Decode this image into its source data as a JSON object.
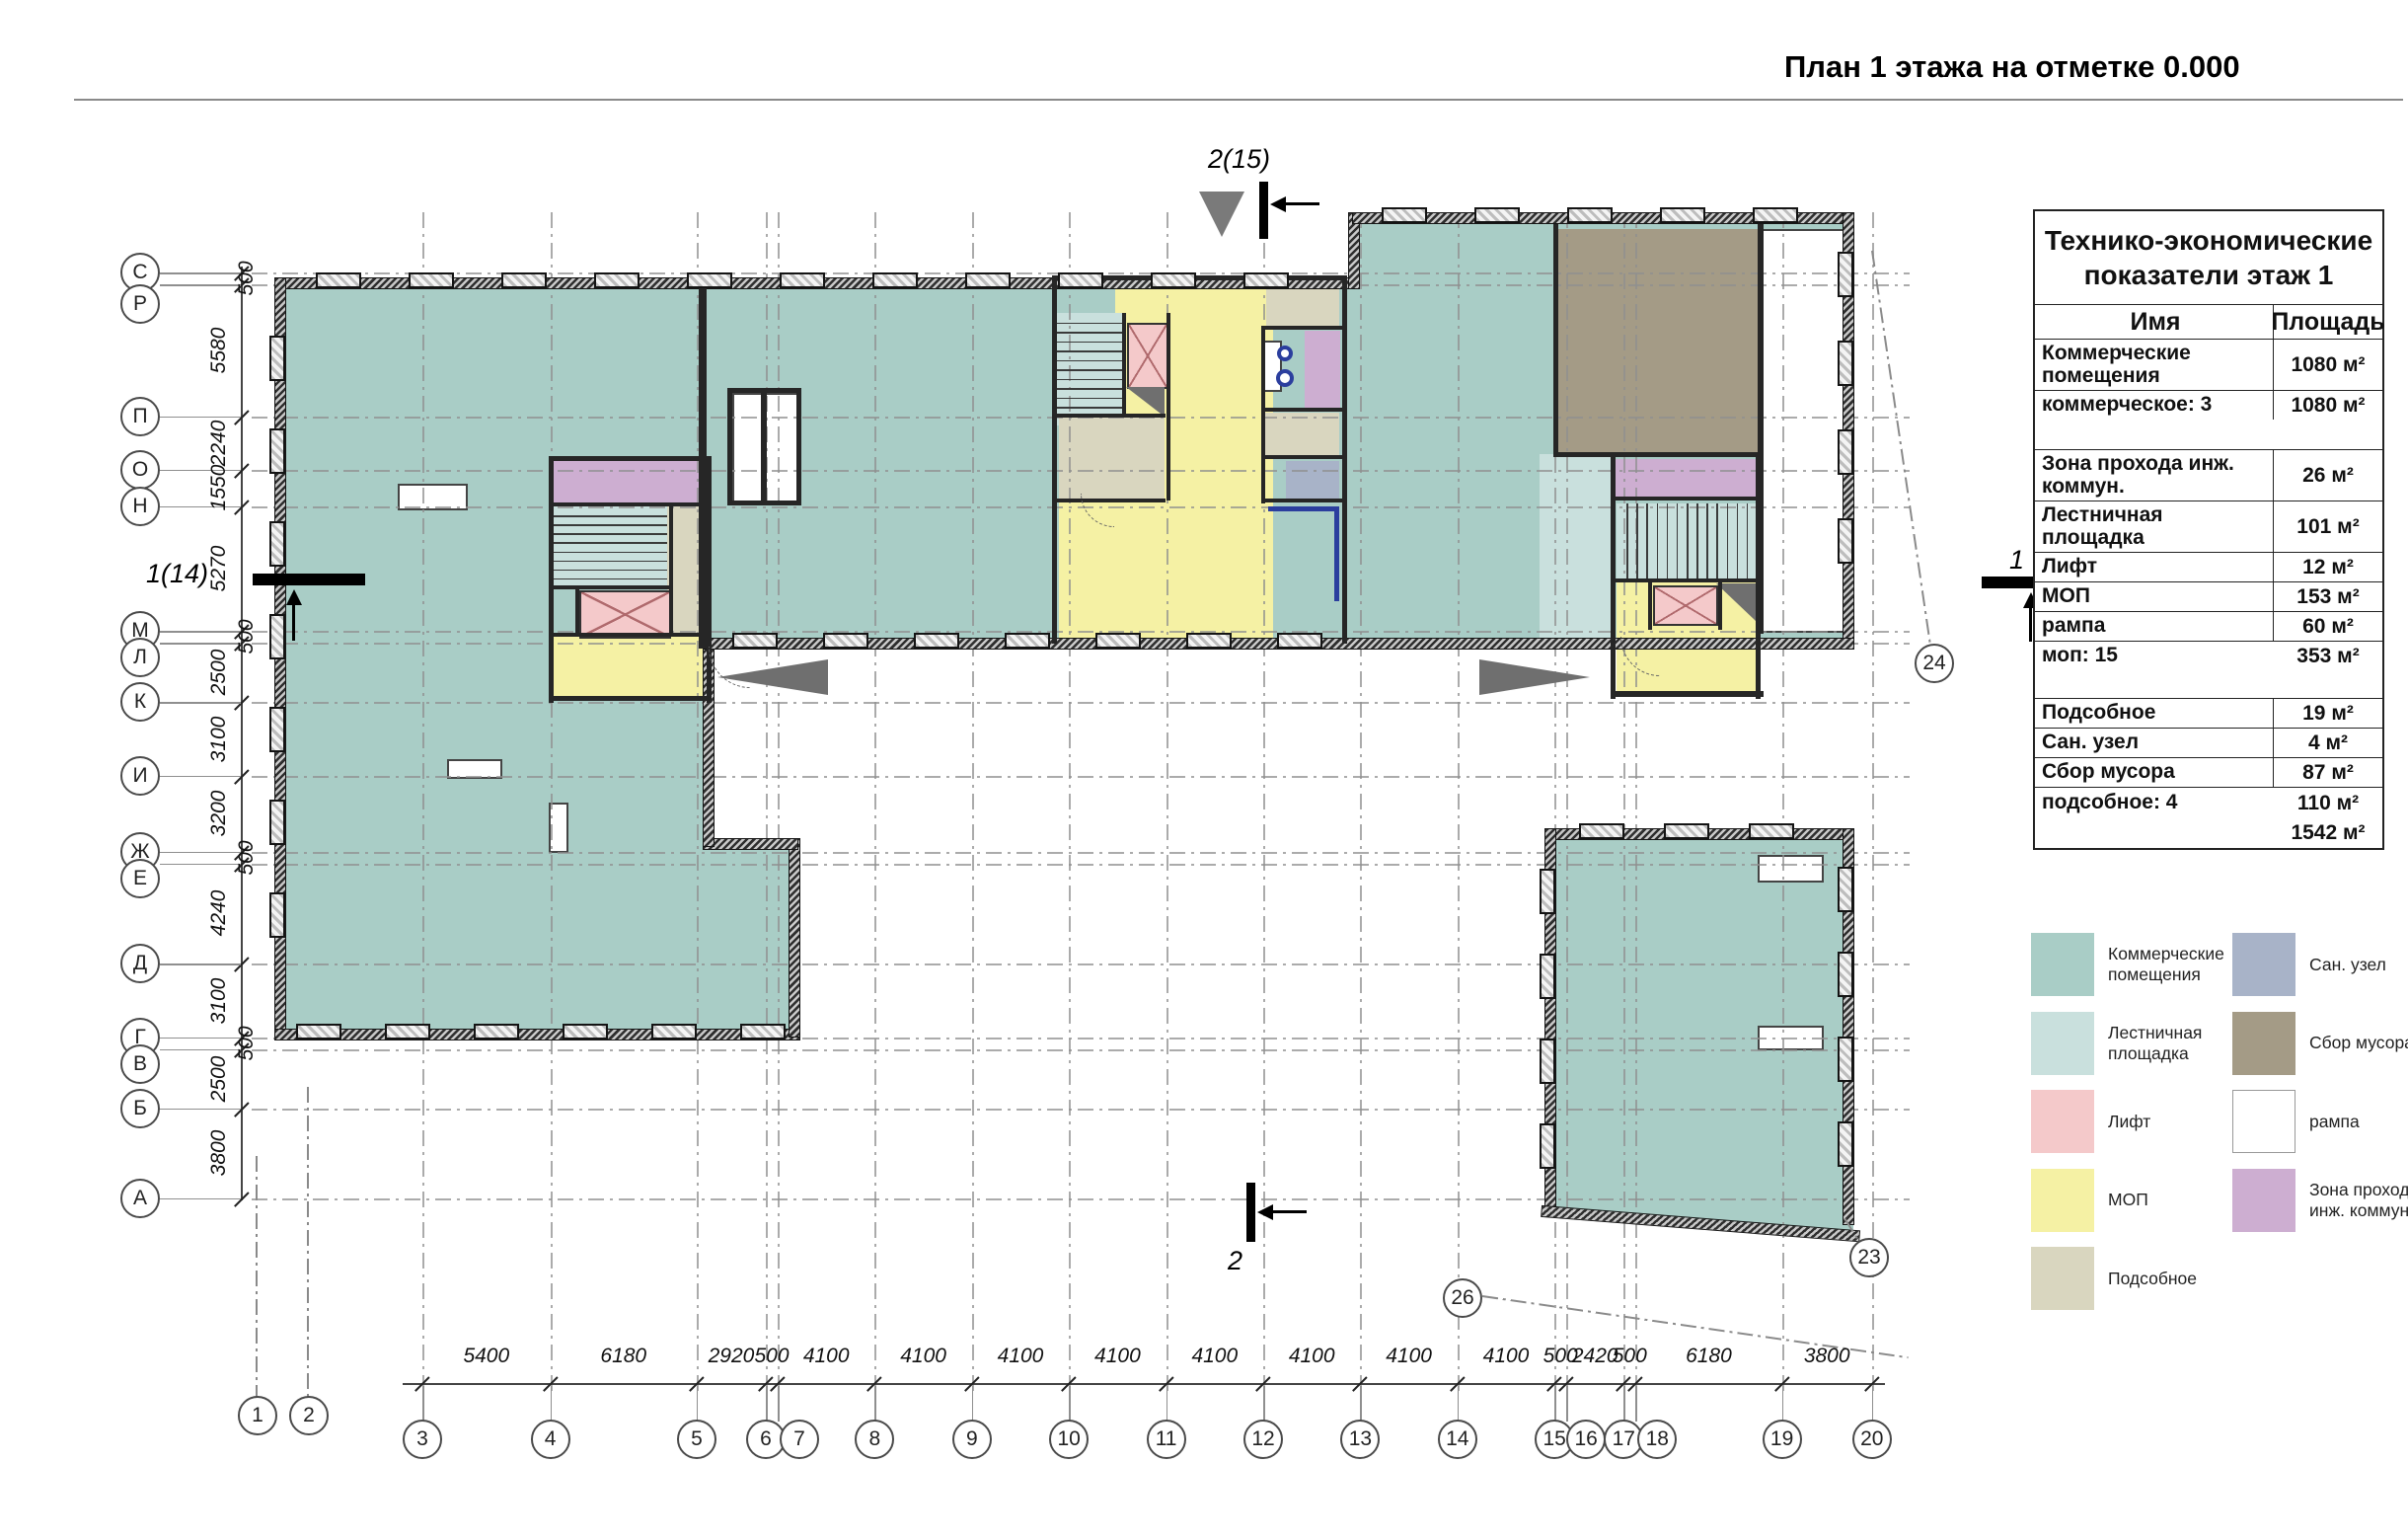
{
  "page": {
    "title": "План 1 этажа на отметке 0.000"
  },
  "plan": {
    "axes": {
      "left_letters": [
        "С",
        "Р",
        "П",
        "О",
        "Н",
        "М",
        "Л",
        "К",
        "И",
        "Ж",
        "Е",
        "Д",
        "Г",
        "В",
        "Б",
        "А"
      ],
      "left_dims": [
        "500",
        "5580",
        "2240",
        "1550",
        "5270",
        "500",
        "2500",
        "3100",
        "3200",
        "500",
        "4240",
        "3100",
        "500",
        "2500",
        "3800"
      ],
      "bottom_numbers": [
        "3",
        "4",
        "5",
        "6",
        "7",
        "8",
        "9",
        "10",
        "11",
        "12",
        "13",
        "14",
        "15",
        "16",
        "17",
        "18",
        "19",
        "20"
      ],
      "extra_numbers": [
        "1",
        "2"
      ],
      "bottom_dims": [
        "5400",
        "6180",
        "2920",
        "500",
        "4100",
        "4100",
        "4100",
        "4100",
        "4100",
        "4100",
        "4100",
        "4100",
        "500",
        "2420",
        "500",
        "6180",
        "3800"
      ],
      "right_bubbles": [
        "24",
        "23",
        "26"
      ]
    },
    "markers": {
      "top": "2(15)",
      "bottom": "2",
      "left": "1(14)",
      "right": "1"
    }
  },
  "table": {
    "title": "Технико-экономические показатели этаж 1",
    "columns": [
      "Имя",
      "Площадь"
    ],
    "rows": [
      {
        "name": "Коммерческие помещения",
        "area": "1080 м²"
      },
      {
        "name": "коммерческое: 3",
        "area": "1080 м²"
      },
      {
        "name": "",
        "area": ""
      },
      {
        "name": "Зона прохода инж. коммун.",
        "area": "26 м²"
      },
      {
        "name": "Лестничная площадка",
        "area": "101 м²"
      },
      {
        "name": "Лифт",
        "area": "12 м²"
      },
      {
        "name": "МОП",
        "area": "153 м²"
      },
      {
        "name": "рампа",
        "area": "60 м²"
      },
      {
        "name": "моп: 15",
        "area": "353 м²"
      },
      {
        "name": "",
        "area": ""
      },
      {
        "name": "Подсобное",
        "area": "19 м²"
      },
      {
        "name": "Сан. узел",
        "area": "4 м²"
      },
      {
        "name": "Сбор мусора",
        "area": "87 м²"
      },
      {
        "name": "подсобное: 4",
        "area": "110 м²"
      },
      {
        "name": "",
        "area": "1542 м²"
      }
    ]
  },
  "legend": {
    "left": [
      {
        "label": "Коммерческие помещения",
        "color": "#a9cdc6"
      },
      {
        "label": "Лестничная площадка",
        "color": "#c9e0dd"
      },
      {
        "label": "Лифт",
        "color": "#f4c9ca"
      },
      {
        "label": "МОП",
        "color": "#f5f1a4"
      },
      {
        "label": "Подсобное",
        "color": "#d9d6bf"
      }
    ],
    "right": [
      {
        "label": "Сан. узел",
        "color": "#a8b3c8"
      },
      {
        "label": "Сбор мусора",
        "color": "#a49b86"
      },
      {
        "label": "рампа",
        "color": "#ffffff"
      },
      {
        "label": "Зона прохода инж. коммун.",
        "color": "#cdaed1"
      }
    ]
  },
  "colors": {
    "wall": "#1c1c1c",
    "grid": "#8a8a8a",
    "accent_blue": "#2b3e9e",
    "triangle_gray": "#6f6f6f",
    "teal": "#a9cdc6",
    "stair": "#c9e0dd",
    "lift": "#f4c9ca",
    "mop": "#f5f1a4",
    "utility": "#d9d6bf",
    "san": "#a8b3c8",
    "trash": "#a49b86",
    "ramp": "#ffffff",
    "zone": "#cdaed1"
  }
}
